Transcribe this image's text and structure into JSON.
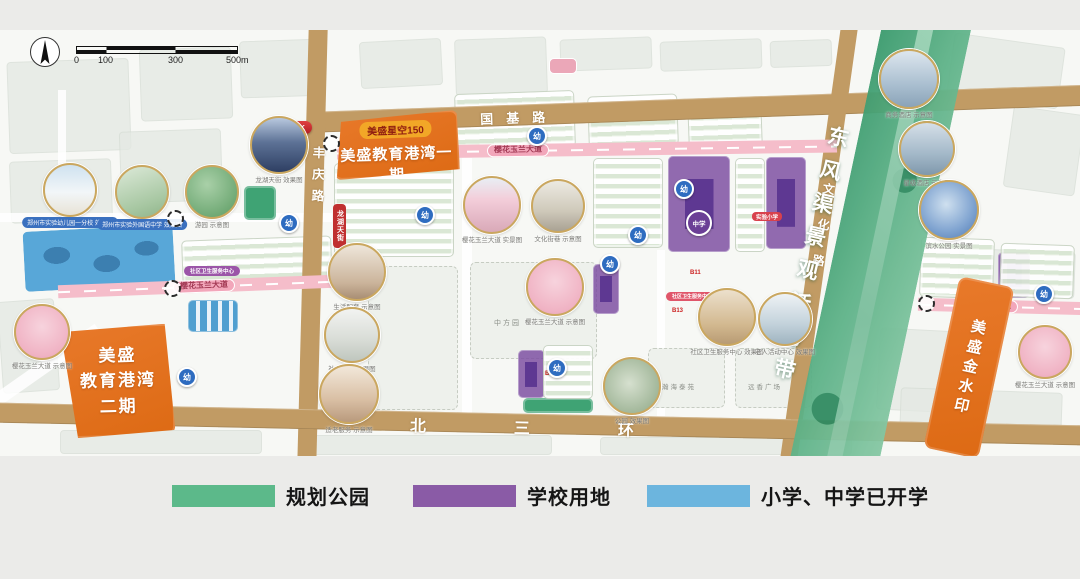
{
  "scale_bar": {
    "ticks": [
      "0",
      "100",
      "300",
      "500m"
    ]
  },
  "roads": {
    "guoji": "国基路",
    "fengqing": "丰庆路",
    "wenhua": "文化路",
    "beisanhuan": "北三环",
    "sakura_avenue": "樱花玉兰大道"
  },
  "green_belt": {
    "label": "东风渠景观活力带"
  },
  "projects": {
    "star150": "美盛星空150",
    "phase1": "美盛教育港湾一期",
    "phase2_line1": "美盛",
    "phase2_line2": "教育港湾",
    "phase2_line3": "二期",
    "jinshuiyin": "美盛金水印"
  },
  "badges": {
    "uu_park": "UU·PARK",
    "longhu_tianjie": "龙湖天街",
    "community_health_1": "社区卫生服务中心",
    "community_health_2": "社区卫生服务中心",
    "school_tag": "实验小学",
    "b11": "B11",
    "b12": "B12",
    "b13": "B13"
  },
  "markers": {
    "kindergarten": "幼",
    "middle_school": "中学"
  },
  "area_labels": {
    "zhongfangyuan": "中方园",
    "hanhai": "瀚海泰苑",
    "plaza": "远香广场"
  },
  "legend": {
    "items": [
      {
        "label": "规划公园",
        "color": "#5cb98a"
      },
      {
        "label": "学校用地",
        "color": "#8a5ba6"
      },
      {
        "label": "小学、中学已开学",
        "color": "#6cb5de"
      }
    ]
  },
  "disclaimer": "本方案仅为总体规划景观概念方案设计，最终以实际情况及最终施工方案为准",
  "photos": [
    {
      "caption": "郑州市实验幼儿园一分校 效果图",
      "kind": "school",
      "pill": true
    },
    {
      "caption": "郑州市实验外国语中学 效果图",
      "kind": "campus",
      "pill": true
    },
    {
      "caption": "游园 示意图",
      "kind": "garden"
    },
    {
      "caption": "龙湖天街 效果图",
      "kind": "city-night"
    },
    {
      "caption": "樱花玉兰大道 实景图",
      "kind": "cherry-street"
    },
    {
      "caption": "文化街巷 示意图",
      "kind": "temple"
    },
    {
      "caption": "樱花玉兰大道 示意图",
      "kind": "cherry"
    },
    {
      "caption": "生活配套 示意图",
      "kind": "people"
    },
    {
      "caption": "社区配套 效果图",
      "kind": "interior"
    },
    {
      "caption": "适老服务 示意图",
      "kind": "elderly"
    },
    {
      "caption": "公园 效果图",
      "kind": "park-aerial"
    },
    {
      "caption": "社区卫生服务中心 效果图",
      "kind": "health"
    },
    {
      "caption": "老人活动中心 效果图",
      "kind": "activity"
    },
    {
      "caption": "商务酒店 示意图",
      "kind": "hotel1"
    },
    {
      "caption": "星级酒店 示意图",
      "kind": "hotel2"
    },
    {
      "caption": "滨水公园 实景图",
      "kind": "art"
    },
    {
      "caption": "樱花玉兰大道 示意图",
      "kind": "cherry"
    },
    {
      "caption": "樱花玉兰大道 示意图",
      "kind": "cherry"
    }
  ]
}
